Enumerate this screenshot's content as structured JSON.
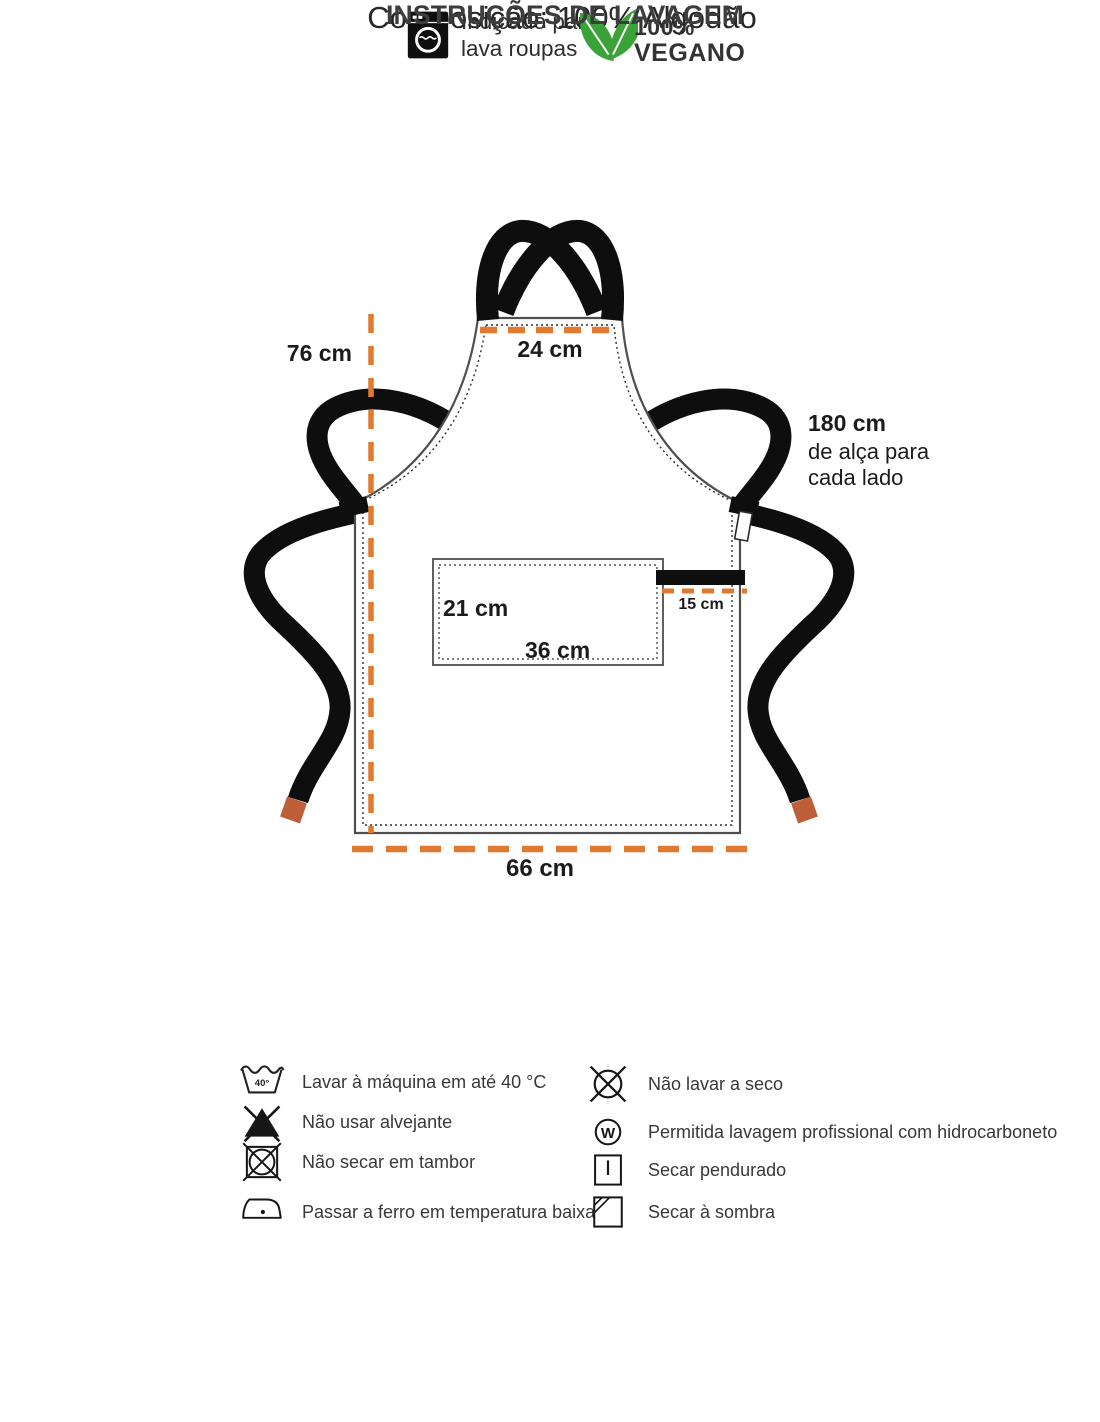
{
  "diagram": {
    "labels": {
      "height": "76 cm",
      "neck_width": "24 cm",
      "strap_line1": "180 cm",
      "strap_line2": "de alça para",
      "strap_line3": "cada lado",
      "pocket_height": "21 cm",
      "pocket_width": "36 cm",
      "waist_strap": "15 cm",
      "bottom_width": "66 cm"
    },
    "colors": {
      "dimension_line": "#e07a30",
      "strap": "#0e0e0e",
      "strap_tip": "#bf5f3a",
      "outline": "#4f4f4f"
    }
  },
  "composition": {
    "text": "Composição: 100% Algodão"
  },
  "features": {
    "machine": {
      "line1": "Indicado para",
      "line2": "lava roupas"
    },
    "vegan": {
      "line1": "100%",
      "line2": "VEGANO",
      "leaf_color": "#3ba23a"
    }
  },
  "care": {
    "title": "INSTRUÇÕES DE LAVAGEM",
    "items_left": [
      {
        "icon": "wash-40-icon",
        "symbol": "40°",
        "label": "Lavar à máquina em até 40 °C"
      },
      {
        "icon": "no-bleach-icon",
        "label": "Não usar alvejante"
      },
      {
        "icon": "no-tumble-dry-icon",
        "label": "Não secar em tambor"
      },
      {
        "icon": "iron-low-temp-icon",
        "label": "Passar a ferro em temperatura baixa"
      }
    ],
    "items_right": [
      {
        "icon": "no-dry-clean-icon",
        "label": "Não lavar a seco"
      },
      {
        "icon": "professional-hydrocarbon-icon",
        "symbol": "W",
        "label": "Permitida lavagem profissional com hidrocarboneto"
      },
      {
        "icon": "hang-dry-icon",
        "label": "Secar pendurado"
      },
      {
        "icon": "dry-in-shade-icon",
        "label": "Secar à sombra"
      }
    ]
  }
}
